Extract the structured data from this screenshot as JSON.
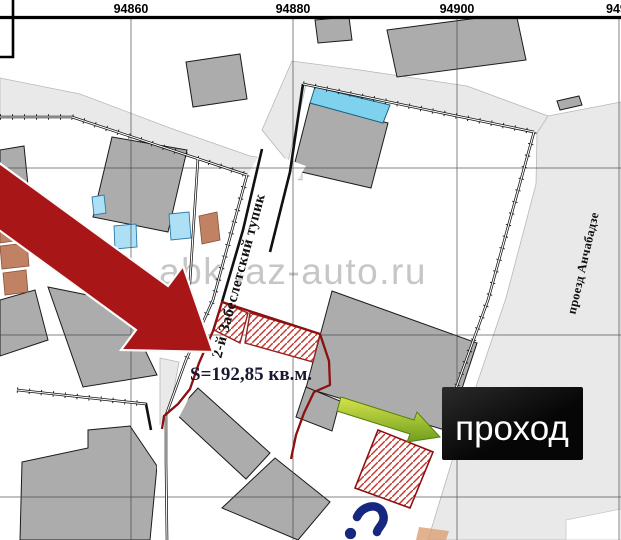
{
  "ruler": {
    "labels": [
      "94860",
      "94880",
      "94900",
      "949"
    ]
  },
  "labels": {
    "street_dead_end": "2-й Забеслетский тупик",
    "street_right": "проезд Анчабадзе",
    "area": "S=192,85 кв.м.",
    "passage": "проход",
    "watermark": "abkhaz-auto.ru"
  },
  "colors": {
    "parcel_boundary_red": "#8c1010",
    "hatch_red": "#c23b32",
    "building_gray": "#acacac",
    "road_gray": "#e9e9e9",
    "highlight_arrow_red": "#a81617",
    "green_arrow": "#8ab422",
    "cyan_building": "#7fd2ee",
    "blue_annex": "#aee0f5",
    "tan_building": "#c08263",
    "passage_box_bg": "#0d0d0d",
    "passage_box_text": "#ffffff"
  }
}
